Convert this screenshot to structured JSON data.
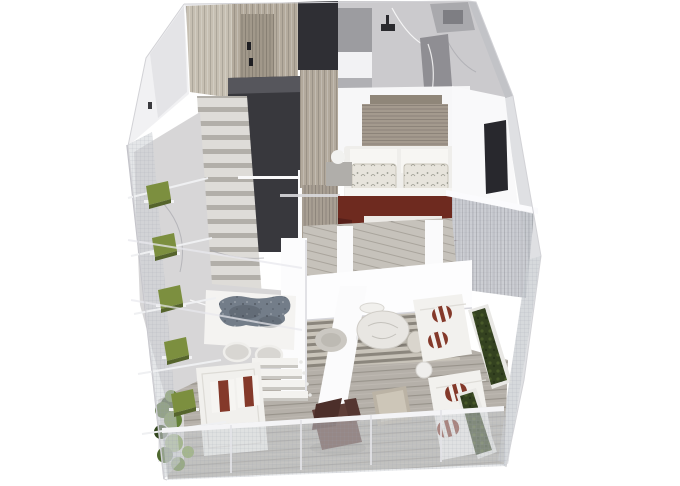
{
  "meta": {
    "description": "3D isometric cutaway rendering of a duplex apartment floor plan with wraparound mesh-screened terrace",
    "view": "axonometric-cutaway",
    "background": "#ffffff"
  },
  "palette": {
    "white_wall": "#fbfbfc",
    "wardrobe_dark": "#38383d",
    "tv_black": "#232327",
    "tv_panel": "#28282d",
    "maroon_throw": "#6e2a1f",
    "maroon_dark": "#57201a",
    "stripe_red": "#84392a",
    "rug_blue_gray": "#737d89",
    "planter_green": "#7c8f3f",
    "hedge_green": "#344220",
    "foliage_greens": [
      "#4e682e",
      "#648238",
      "#7c9a46"
    ],
    "chair_brown": "#5f3e38",
    "marble_light": "#cbcacd",
    "marble_terrace": "#d7d6d7",
    "marble_partition": "#8f8e93",
    "wood_entry": "#c6bfb2",
    "wood_door": "#b4ab9d",
    "wood_corridor": "#b2a99c",
    "headboard_wood": "#a49a8e",
    "deck_wood": "#b5b0a9",
    "mesh_gray": "#ced1d6"
  },
  "scene": {
    "upper_level": {
      "rooms": [
        {
          "name": "entry-hall",
          "items": [
            "wood-plank-wall",
            "entry-door",
            "dark-wardrobe"
          ]
        },
        {
          "name": "staircase",
          "items": [
            "marble-steps",
            "glass-balustrade"
          ]
        },
        {
          "name": "bathroom",
          "items": [
            "marble-floor",
            "marble-partition",
            "shower-fixture",
            "vanity-with-basin",
            "gray-cabinet"
          ]
        },
        {
          "name": "bedroom",
          "items": [
            "slatted-headboard-wall",
            "double-bed",
            "patterned-pillows",
            "maroon-throw",
            "foot-bench",
            "tv-console",
            "nightstand-left",
            "nightstand-right",
            "sphere-lamps",
            "wall-tv-panel"
          ]
        },
        {
          "name": "bedroom-balcony",
          "items": [
            "mesh-screen",
            "white-railing"
          ]
        }
      ]
    },
    "lower_level": {
      "rooms": [
        {
          "name": "terrace-lounge",
          "items": [
            "marble-floor",
            "blue-gray-rug",
            "wire-chairs",
            "terrace-steps",
            "daybed-with-striped-pillows",
            "leafy-plants"
          ]
        },
        {
          "name": "dining-deck",
          "items": [
            "slatted-floor",
            "round-marble-table",
            "dining-chairs",
            "round-pouf"
          ]
        },
        {
          "name": "sofa-terrace",
          "items": [
            "sofa-upper",
            "sofa-lower",
            "striped-bolsters",
            "hedge-planters",
            "side-table"
          ]
        },
        {
          "name": "wood-deck",
          "items": [
            "plank-floor",
            "brown-lounge-chair",
            "wood-coffee-table"
          ]
        }
      ]
    },
    "exterior": {
      "items": [
        "mesh-facade-left",
        "facade-planter-boxes",
        "mesh-railing-bottom",
        "mesh-railing-right",
        "white-shell-walls"
      ]
    }
  }
}
